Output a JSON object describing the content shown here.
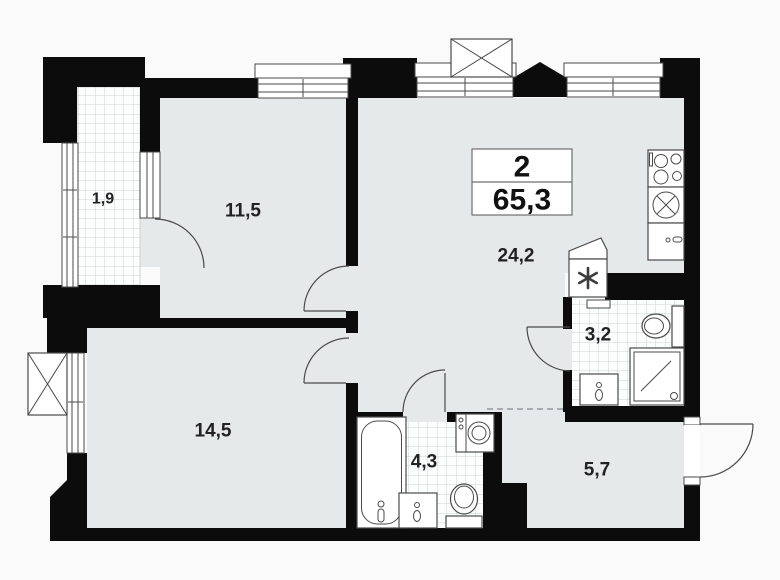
{
  "plan": {
    "title_block": {
      "rooms_count": "2",
      "total_area": "65,3"
    },
    "rooms": [
      {
        "id": "balcony",
        "area_label": "1,9"
      },
      {
        "id": "bedroom-1",
        "area_label": "11,5"
      },
      {
        "id": "living-kitchen",
        "area_label": "24,2"
      },
      {
        "id": "bathroom-small",
        "area_label": "3,2"
      },
      {
        "id": "bedroom-2",
        "area_label": "14,5"
      },
      {
        "id": "bathroom-large",
        "area_label": "4,3"
      },
      {
        "id": "hallway",
        "area_label": "5,7"
      }
    ],
    "colors": {
      "wall": "#0c0c0c",
      "floor": "#e6e9ea",
      "tileBg": "#fcfdfd",
      "tileLine": "#ccd2d3",
      "outline": "#4a4a4a",
      "bg": "#fafafa",
      "label": "#222224"
    }
  }
}
